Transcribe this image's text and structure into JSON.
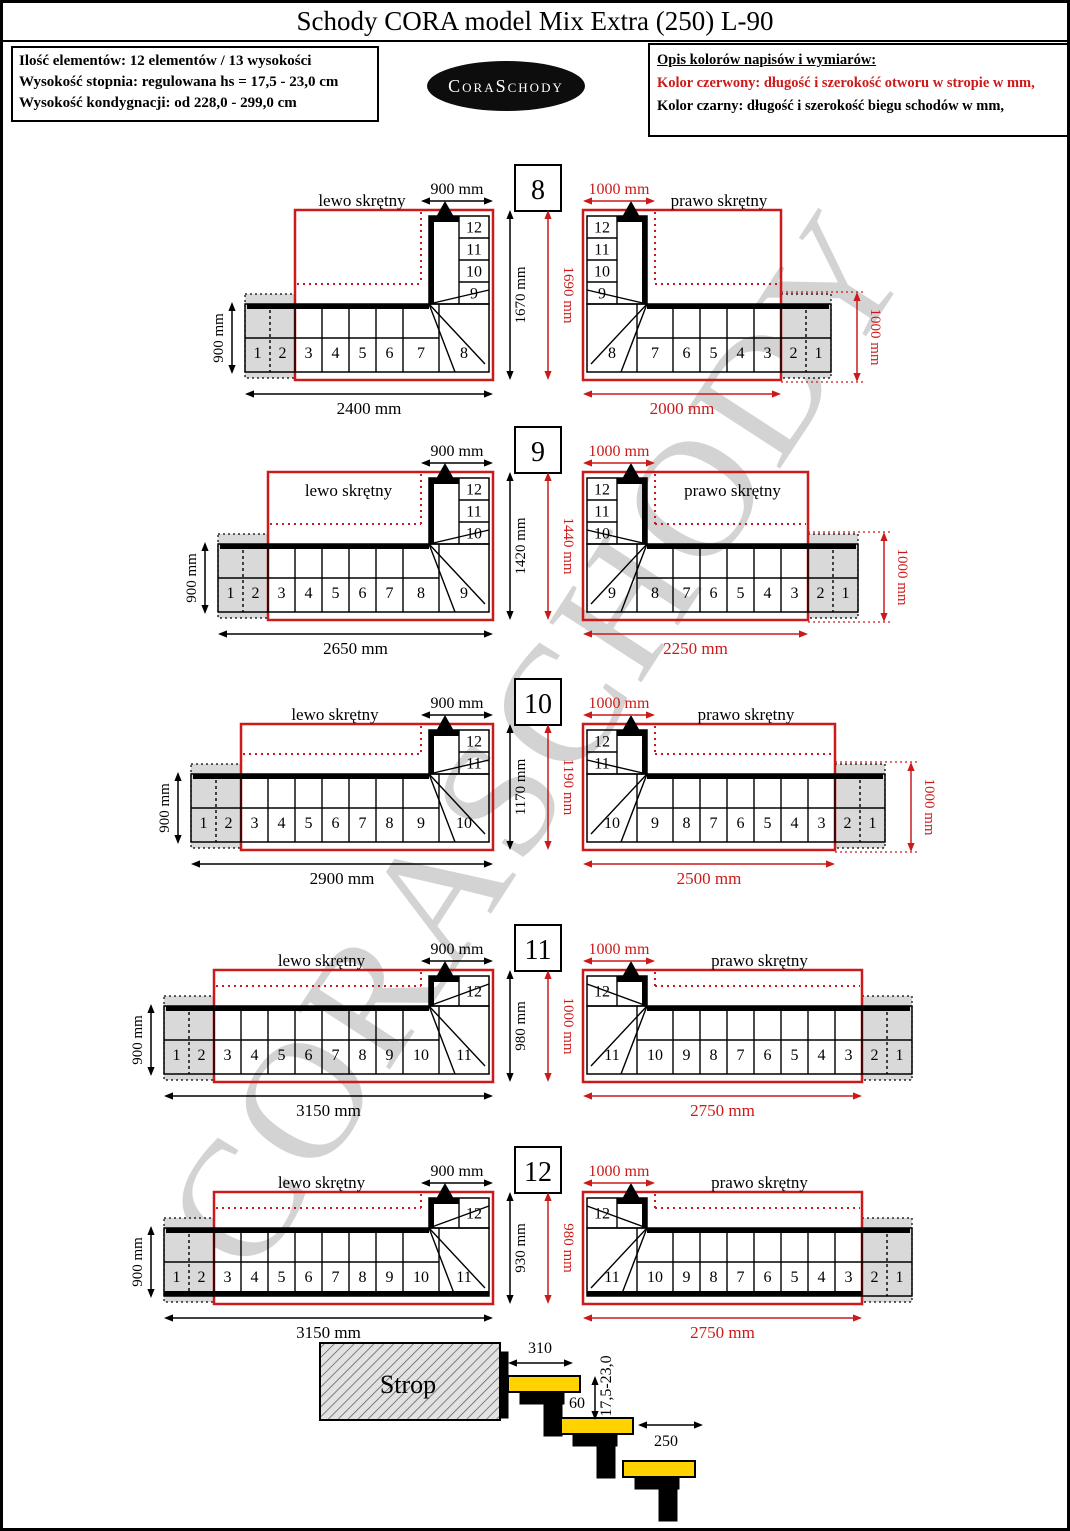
{
  "title": "Schody CORA model Mix Extra (250) L-90",
  "info_box": {
    "lines": [
      "Ilość elementów: 12 elementów / 13 wysokości",
      "Wysokość stopnia: regulowana  hs = 17,5 - 23,0 cm",
      "Wysokość kondygnacji: od 228,0 - 299,0 cm"
    ]
  },
  "logo": {
    "text": "CoraSchody"
  },
  "legend": {
    "title": "Opis kolorów napisów i wymiarów:",
    "red_line": "Kolor czerwony:  długość i szerokość otworu w stropie w mm,",
    "black_line": "Kolor czarny:  długość i szerokość biegu schodów w mm,"
  },
  "watermark_text": "CORASCHODY",
  "colors": {
    "red": "#cc1a1a",
    "black": "#000000",
    "gray_fill": "#d9d9d9",
    "yellow": "#ffd200",
    "watermark": "#c9c9c9"
  },
  "rows": [
    {
      "number": "8",
      "middle": {
        "black": "1670 mm",
        "red": "1690 mm"
      },
      "left": {
        "label": "lewo skrętny",
        "top": "900 mm",
        "side": "900 mm",
        "bottom": "2400 mm",
        "bottom_steps": [
          "1",
          "2",
          "3",
          "4",
          "5",
          "6",
          "7",
          "8"
        ],
        "vert_steps": [
          "12",
          "11",
          "10",
          "9"
        ]
      },
      "right": {
        "label": "prawo skrętny",
        "top": "1000 mm",
        "side": "1000 mm",
        "bottom": "2000 mm",
        "bottom_steps": [
          "8",
          "7",
          "6",
          "5",
          "4",
          "3",
          "2",
          "1"
        ],
        "vert_steps": [
          "12",
          "11",
          "10",
          "9"
        ]
      }
    },
    {
      "number": "9",
      "label_inside": true,
      "middle": {
        "black": "1420 mm",
        "red": "1440 mm"
      },
      "left": {
        "label": "lewo skrętny",
        "top": "900 mm",
        "side": "900 mm",
        "bottom": "2650 mm",
        "bottom_steps": [
          "1",
          "2",
          "3",
          "4",
          "5",
          "6",
          "7",
          "8",
          "9"
        ],
        "vert_steps": [
          "12",
          "11",
          "10"
        ]
      },
      "right": {
        "label": "prawo skrętny",
        "top": "1000 mm",
        "side": "1000 mm",
        "bottom": "2250 mm",
        "bottom_steps": [
          "9",
          "8",
          "7",
          "6",
          "5",
          "4",
          "3",
          "2",
          "1"
        ],
        "vert_steps": [
          "12",
          "11",
          "10"
        ]
      }
    },
    {
      "number": "10",
      "middle": {
        "black": "1170 mm",
        "red": "1190 mm"
      },
      "left": {
        "label": "lewo skrętny",
        "top": "900 mm",
        "side": "900 mm",
        "bottom": "2900 mm",
        "bottom_steps": [
          "1",
          "2",
          "3",
          "4",
          "5",
          "6",
          "7",
          "8",
          "9",
          "10"
        ],
        "vert_steps": [
          "12",
          "11"
        ]
      },
      "right": {
        "label": "prawo skrętny",
        "top": "1000 mm",
        "side": "1000 mm",
        "bottom": "2500 mm",
        "bottom_steps": [
          "10",
          "9",
          "8",
          "7",
          "6",
          "5",
          "4",
          "3",
          "2",
          "1"
        ],
        "vert_steps": [
          "12",
          "11"
        ]
      }
    },
    {
      "number": "11",
      "middle": {
        "black": "980 mm",
        "red": "1000 mm"
      },
      "left": {
        "label": "lewo skrętny",
        "top": "900 mm",
        "side": "900 mm",
        "bottom": "3150 mm",
        "bottom_steps": [
          "1",
          "2",
          "3",
          "4",
          "5",
          "6",
          "7",
          "8",
          "9",
          "10",
          "11"
        ],
        "vert_steps": [
          "12"
        ]
      },
      "right": {
        "label": "prawo skrętny",
        "top": "1000 mm",
        "side": null,
        "bottom": "2750 mm",
        "bottom_steps": [
          "11",
          "10",
          "9",
          "8",
          "7",
          "6",
          "5",
          "4",
          "3",
          "2",
          "1"
        ],
        "vert_steps": [
          "12"
        ]
      }
    },
    {
      "number": "12",
      "bold_bottom": true,
      "middle": {
        "black": "930 mm",
        "red": "980 mm"
      },
      "left": {
        "label": "lewo skrętny",
        "top": "900 mm",
        "side": "900 mm",
        "bottom": "3150 mm",
        "bottom_steps": [
          "1",
          "2",
          "3",
          "4",
          "5",
          "6",
          "7",
          "8",
          "9",
          "10",
          "11"
        ],
        "vert_steps": [
          "12"
        ]
      },
      "right": {
        "label": "prawo skrętny",
        "top": "1000 mm",
        "side": null,
        "bottom": "2750 mm",
        "bottom_steps": [
          "11",
          "10",
          "9",
          "8",
          "7",
          "6",
          "5",
          "4",
          "3",
          "2",
          "1"
        ],
        "vert_steps": [
          "12"
        ]
      }
    }
  ],
  "cross_section": {
    "strop_label": "Strop",
    "tread_top": "310",
    "riser_range": "17,5-23,0",
    "gap": "60",
    "tread_lower": "250"
  }
}
